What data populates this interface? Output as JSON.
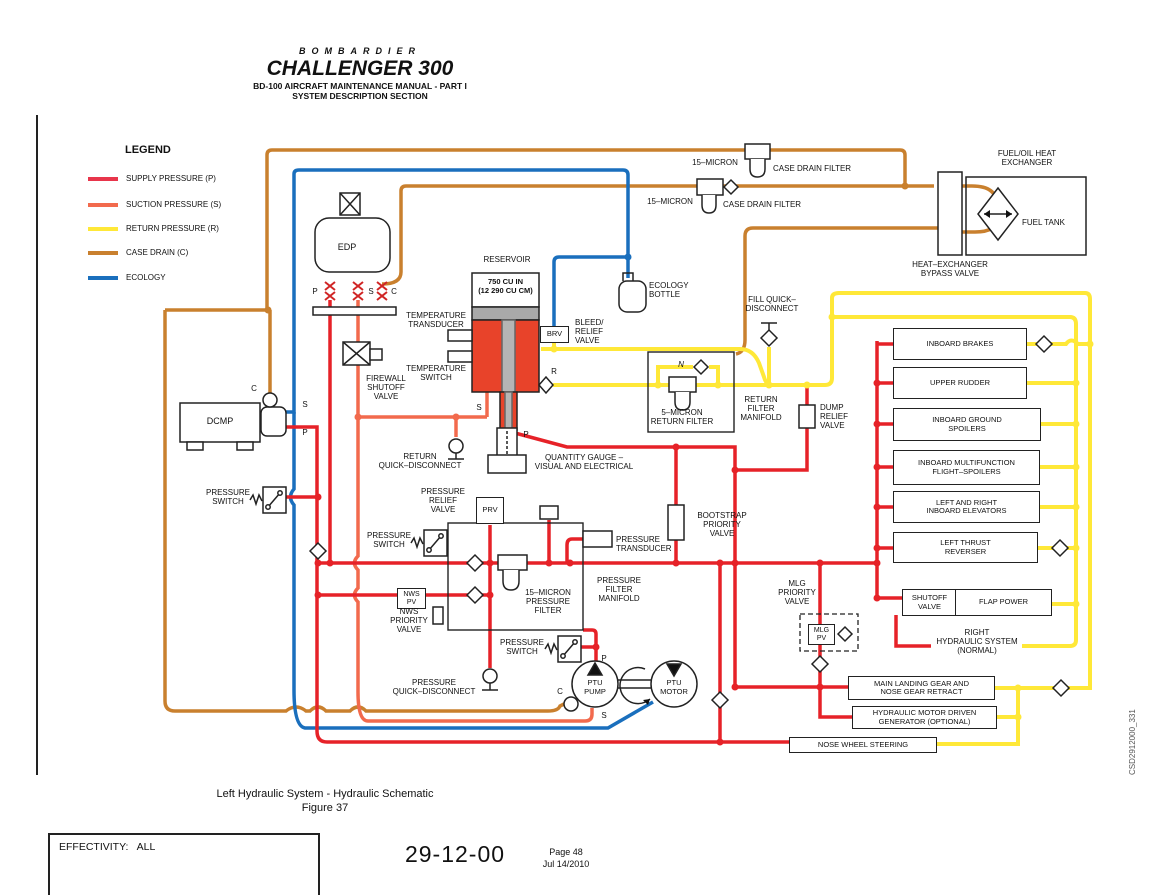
{
  "header": {
    "brand": "BOMBARDIER",
    "model": "CHALLENGER 300",
    "manual_line1": "BD-100 AIRCRAFT MAINTENANCE MANUAL - PART I",
    "manual_line2": "SYSTEM DESCRIPTION SECTION"
  },
  "legend": {
    "title": "LEGEND",
    "items": [
      {
        "label": "SUPPLY PRESSURE (P)",
        "color": "#e8354b"
      },
      {
        "label": "SUCTION PRESSURE (S)",
        "color": "#f26a4d"
      },
      {
        "label": "RETURN PRESSURE (R)",
        "color": "#ffe838"
      },
      {
        "label": "CASE DRAIN (C)",
        "color": "#c9802e"
      },
      {
        "label": "ECOLOGY",
        "color": "#1a6fbd"
      }
    ]
  },
  "labels": {
    "edp": "EDP",
    "p": "P",
    "s": "S",
    "c": "C",
    "r": "R",
    "n": "N",
    "firewall_sov": "FIREWALL\nSHUTOFF\nVALVE",
    "dcmp": "DCMP",
    "pressure_switch": "PRESSURE\nSWITCH",
    "reservoir": "RESERVOIR",
    "capacity": "750 CU IN\n(12 290 CU CM)",
    "temp_transducer": "TEMPERATURE\nTRANSDUCER",
    "temp_switch": "TEMPERATURE\nSWITCH",
    "brv": "BRV",
    "bleed_relief": "BLEED/\nRELIEF\nVALVE",
    "return_qd": "RETURN\nQUICK–DISCONNECT",
    "quantity_gauge": "QUANTITY GAUGE –\nVISUAL AND ELECTRICAL",
    "ecology_bottle": "ECOLOGY\nBOTTLE",
    "micron15": "15–MICRON",
    "case_drain_filter": "CASE DRAIN FILTER",
    "fuel_oil_hx": "FUEL/OIL HEAT\nEXCHANGER",
    "fuel_tank": "FUEL TANK",
    "hx_bypass": "HEAT–EXCHANGER\nBYPASS VALVE",
    "fill_qd": "FILL QUICK–\nDISCONNECT",
    "return_filter": "5–MICRON\nRETURN FILTER",
    "return_manifold": "RETURN\nFILTER\nMANIFOLD",
    "dump_relief": "DUMP\nRELIEF\nVALVE",
    "bootstrap": "BOOTSTRAP\nPRIORITY\nVALVE",
    "pressure_relief": "PRESSURE\nRELIEF\nVALVE",
    "prv": "PRV",
    "pressure_transducer": "PRESSURE\nTRANSDUCER",
    "nws_pv": "NWS\nPV",
    "nws_priority": "NWS\nPRIORITY\nVALVE",
    "pressure_filter": "15–MICRON\nPRESSURE\nFILTER",
    "pf_manifold": "PRESSURE\nFILTER\nMANIFOLD",
    "pressure_qd": "PRESSURE\nQUICK–DISCONNECT",
    "ptu_pump": "PTU\nPUMP",
    "ptu_motor": "PTU\nMOTOR",
    "mlg_priority": "MLG\nPRIORITY\nVALVE",
    "mlg_pv": "MLG\nPV",
    "shutoff_valve": "SHUTOFF\nVALVE",
    "flap_power": "FLAP POWER",
    "right_hyd": "RIGHT\nHYDRAULIC SYSTEM\n(NORMAL)"
  },
  "consumers": [
    "INBOARD BRAKES",
    "UPPER RUDDER",
    "INBOARD GROUND\nSPOILERS",
    "INBOARD MULTIFUNCTION\nFLIGHT–SPOILERS",
    "LEFT AND RIGHT\nINBOARD ELEVATORS",
    "LEFT THRUST\nREVERSER"
  ],
  "bottom_boxes": {
    "mlg": "MAIN LANDING GEAR AND\nNOSE GEAR RETRACT",
    "hmdg": "HYDRAULIC MOTOR DRIVEN\nGENERATOR (OPTIONAL)",
    "nws": "NOSE WHEEL STEERING"
  },
  "caption": {
    "line1": "Left Hydraulic System - Hydraulic Schematic",
    "line2": "Figure 37"
  },
  "footer": {
    "effectivity_label": "EFFECTIVITY:",
    "effectivity_value": "ALL",
    "ata": "29-12-00",
    "page": "Page 48",
    "date": "Jul 14/2010"
  },
  "watermark": "CSD2912000_331",
  "colors": {
    "supply": "#e62228",
    "suction": "#f26a4d",
    "return": "#ffe838",
    "case_drain": "#c9802e",
    "ecology": "#1a6fbd"
  }
}
